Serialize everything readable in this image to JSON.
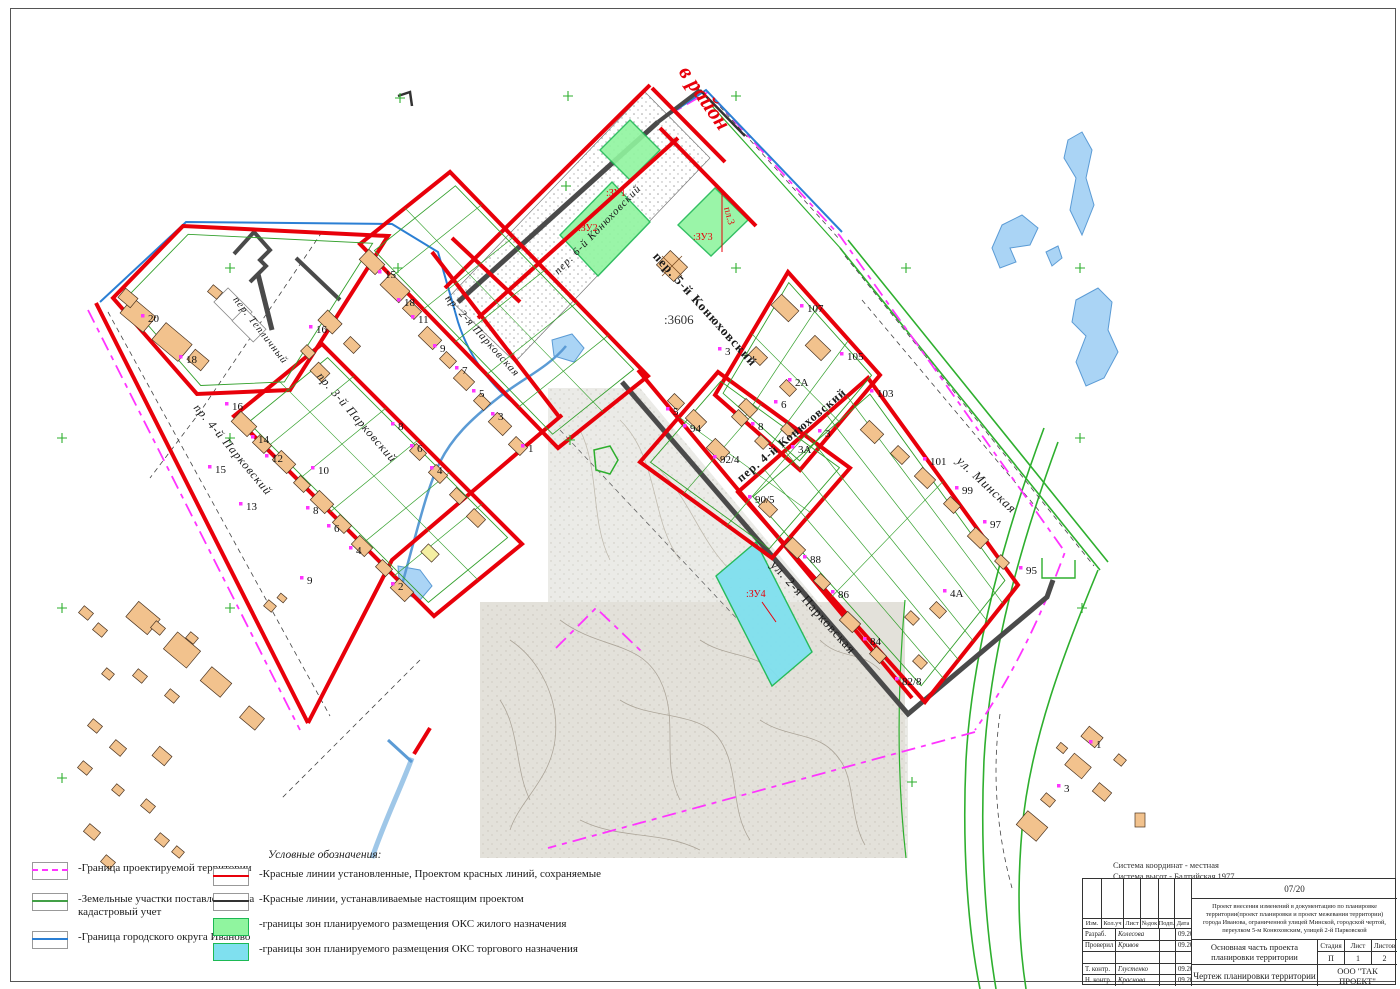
{
  "colors": {
    "red_line": "#e8000a",
    "new_red_line": "#4a4a4a",
    "boundary_magenta": "#ff34ff",
    "cadastral_green": "#2eaf2e",
    "city_boundary_blue": "#2b7fd4",
    "zone_residential": "#90f59f",
    "zone_trade": "#7fe0ef",
    "building_fill": "#f2c28d",
    "water": "#aad4f5"
  },
  "annotations": {
    "direction_note": "в район",
    "cadastral_number": ":3606",
    "legend_title": "Условные обозначения:",
    "coord_system_line1": "Система координат - местная",
    "coord_system_line2": "Система высот - Балтийская 1977"
  },
  "streets": [
    {
      "name": "пер. Тепличный",
      "x": 258,
      "y": 332,
      "rot": 52,
      "size": 10.5,
      "style": "italic"
    },
    {
      "name": "пр. 4-й Парковский",
      "x": 230,
      "y": 452,
      "rot": 50,
      "size": 12,
      "style": "italic"
    },
    {
      "name": "пр. 3-й Парковский",
      "x": 354,
      "y": 420,
      "rot": 49,
      "size": 12,
      "style": "italic"
    },
    {
      "name": "пр. 2-я Парковская",
      "x": 480,
      "y": 338,
      "rot": 48,
      "size": 11,
      "style": "italic"
    },
    {
      "name": "пер. 6-й Конюховский",
      "x": 600,
      "y": 232,
      "rot": -46,
      "size": 11,
      "style": "italic"
    },
    {
      "name": "пер. 5-й Конюховский",
      "x": 702,
      "y": 312,
      "rot": 48,
      "size": 13,
      "style": "bold"
    },
    {
      "name": "пер. 4-й Конюховский",
      "x": 794,
      "y": 438,
      "rot": -40,
      "size": 12,
      "style": "bold"
    },
    {
      "name": "ул. 2-я Парковская",
      "x": 810,
      "y": 610,
      "rot": 48,
      "size": 13,
      "style": "normal"
    },
    {
      "name": "ул. Минская",
      "x": 984,
      "y": 488,
      "rot": 43,
      "size": 13,
      "style": "italic"
    }
  ],
  "zone_labels": [
    {
      "label": ":ЗУ1",
      "x": 606,
      "y": 196,
      "rot": 0
    },
    {
      "label": ":ЗУ2",
      "x": 578,
      "y": 231,
      "rot": 0
    },
    {
      "label": ":ЗУ3",
      "x": 693,
      "y": 240,
      "rot": 0
    },
    {
      "label": "пл.3",
      "x": 724,
      "y": 208,
      "rot": 75
    },
    {
      "label": ":ЗУ4",
      "x": 746,
      "y": 597,
      "rot": 0
    }
  ],
  "house_numbers": [
    {
      "x": 148,
      "y": 322,
      "label": "20"
    },
    {
      "x": 186,
      "y": 363,
      "label": "18"
    },
    {
      "x": 385,
      "y": 278,
      "label": "15"
    },
    {
      "x": 404,
      "y": 306,
      "label": "18"
    },
    {
      "x": 316,
      "y": 333,
      "label": "16"
    },
    {
      "x": 418,
      "y": 323,
      "label": "11"
    },
    {
      "x": 440,
      "y": 352,
      "label": "9"
    },
    {
      "x": 462,
      "y": 374,
      "label": "7"
    },
    {
      "x": 479,
      "y": 397,
      "label": "5"
    },
    {
      "x": 498,
      "y": 420,
      "label": "3"
    },
    {
      "x": 528,
      "y": 452,
      "label": "1"
    },
    {
      "x": 232,
      "y": 410,
      "label": "16"
    },
    {
      "x": 258,
      "y": 443,
      "label": "14"
    },
    {
      "x": 272,
      "y": 462,
      "label": "12"
    },
    {
      "x": 318,
      "y": 474,
      "label": "10"
    },
    {
      "x": 313,
      "y": 514,
      "label": "8"
    },
    {
      "x": 334,
      "y": 532,
      "label": "6"
    },
    {
      "x": 356,
      "y": 554,
      "label": "4"
    },
    {
      "x": 398,
      "y": 590,
      "label": "2"
    },
    {
      "x": 215,
      "y": 473,
      "label": "15"
    },
    {
      "x": 246,
      "y": 510,
      "label": "13"
    },
    {
      "x": 307,
      "y": 584,
      "label": "9"
    },
    {
      "x": 398,
      "y": 430,
      "label": "8"
    },
    {
      "x": 417,
      "y": 452,
      "label": "6"
    },
    {
      "x": 437,
      "y": 474,
      "label": "4"
    },
    {
      "x": 807,
      "y": 312,
      "label": "107"
    },
    {
      "x": 847,
      "y": 360,
      "label": "105"
    },
    {
      "x": 877,
      "y": 397,
      "label": "103"
    },
    {
      "x": 930,
      "y": 465,
      "label": "101"
    },
    {
      "x": 962,
      "y": 494,
      "label": "99"
    },
    {
      "x": 990,
      "y": 528,
      "label": "97"
    },
    {
      "x": 1026,
      "y": 574,
      "label": "95"
    },
    {
      "x": 795,
      "y": 386,
      "label": "2А"
    },
    {
      "x": 725,
      "y": 355,
      "label": "3"
    },
    {
      "x": 673,
      "y": 415,
      "label": "5"
    },
    {
      "x": 690,
      "y": 432,
      "label": "94"
    },
    {
      "x": 758,
      "y": 430,
      "label": "8"
    },
    {
      "x": 781,
      "y": 408,
      "label": "6"
    },
    {
      "x": 720,
      "y": 463,
      "label": "92/4"
    },
    {
      "x": 825,
      "y": 437,
      "label": "3"
    },
    {
      "x": 798,
      "y": 453,
      "label": "3А"
    },
    {
      "x": 755,
      "y": 503,
      "label": "90/5"
    },
    {
      "x": 810,
      "y": 563,
      "label": "88"
    },
    {
      "x": 838,
      "y": 598,
      "label": "86"
    },
    {
      "x": 870,
      "y": 645,
      "label": "84"
    },
    {
      "x": 950,
      "y": 597,
      "label": "4А"
    },
    {
      "x": 902,
      "y": 685,
      "label": "82/8"
    },
    {
      "x": 1096,
      "y": 748,
      "label": "1"
    },
    {
      "x": 1064,
      "y": 792,
      "label": "3"
    }
  ],
  "legend": {
    "title": "Условные обозначения:",
    "col1": [
      {
        "label": "-Граница проектируемой территории",
        "swatch": "dashed-line",
        "color": "#ff34ff"
      },
      {
        "label": "-Земельные участки поставленные на кадастровый учет",
        "swatch": "line",
        "color": "#43a047"
      },
      {
        "label": "-Граница городского округа Иваново",
        "swatch": "line",
        "color": "#2b7fd4"
      }
    ],
    "col2": [
      {
        "label": "-Красные линии установленные, Проектом красных линий, сохраняемые",
        "swatch": "line",
        "color": "#e8000a"
      },
      {
        "label": "-Красные линии, устанавливаемые настоящим проектом",
        "swatch": "line",
        "color": "#333333"
      },
      {
        "label": "-границы зон планируемого размещения ОКС жилого назначения",
        "swatch": "fill",
        "color": "#90f59f"
      },
      {
        "label": "-границы зон планируемого размещения ОКС торгового назначения",
        "swatch": "fill",
        "color": "#7fe0ef"
      }
    ]
  },
  "titleblock": {
    "doc_number": "07/20",
    "project_description": "Проект внесения изменений в документацию по планировке территории(проект планировки и проект межевания территории) города Иванова, ограниченной улицей Минской, городской чертой, переулком 5-м Конюховским, улицей 2-й Парковской",
    "section_title": "Основная часть проекта планировки территории",
    "sheet_title": "Чертеж планировки территории",
    "company": "ООО \"ТАК ПРОЕКТ\"",
    "stage_label": "Стадия",
    "sheet_label": "Лист",
    "sheets_label": "Листов",
    "stage": "П",
    "sheet": "1",
    "sheets": "2",
    "header_cols": [
      "Изм.",
      "Кол.уч",
      "Лист",
      "№док",
      "Подп.",
      "Дата"
    ],
    "rows": [
      {
        "role": "Разраб.",
        "name": "Колесова",
        "date": "09.2020"
      },
      {
        "role": "Проверил",
        "name": "Кривов",
        "date": "09.2020"
      },
      {
        "role": "",
        "name": "",
        "date": ""
      },
      {
        "role": "Т. контр.",
        "name": "Глустенко",
        "date": "09.2020"
      },
      {
        "role": "Н. контр.",
        "name": "Краснова",
        "date": "09.2020"
      }
    ]
  }
}
